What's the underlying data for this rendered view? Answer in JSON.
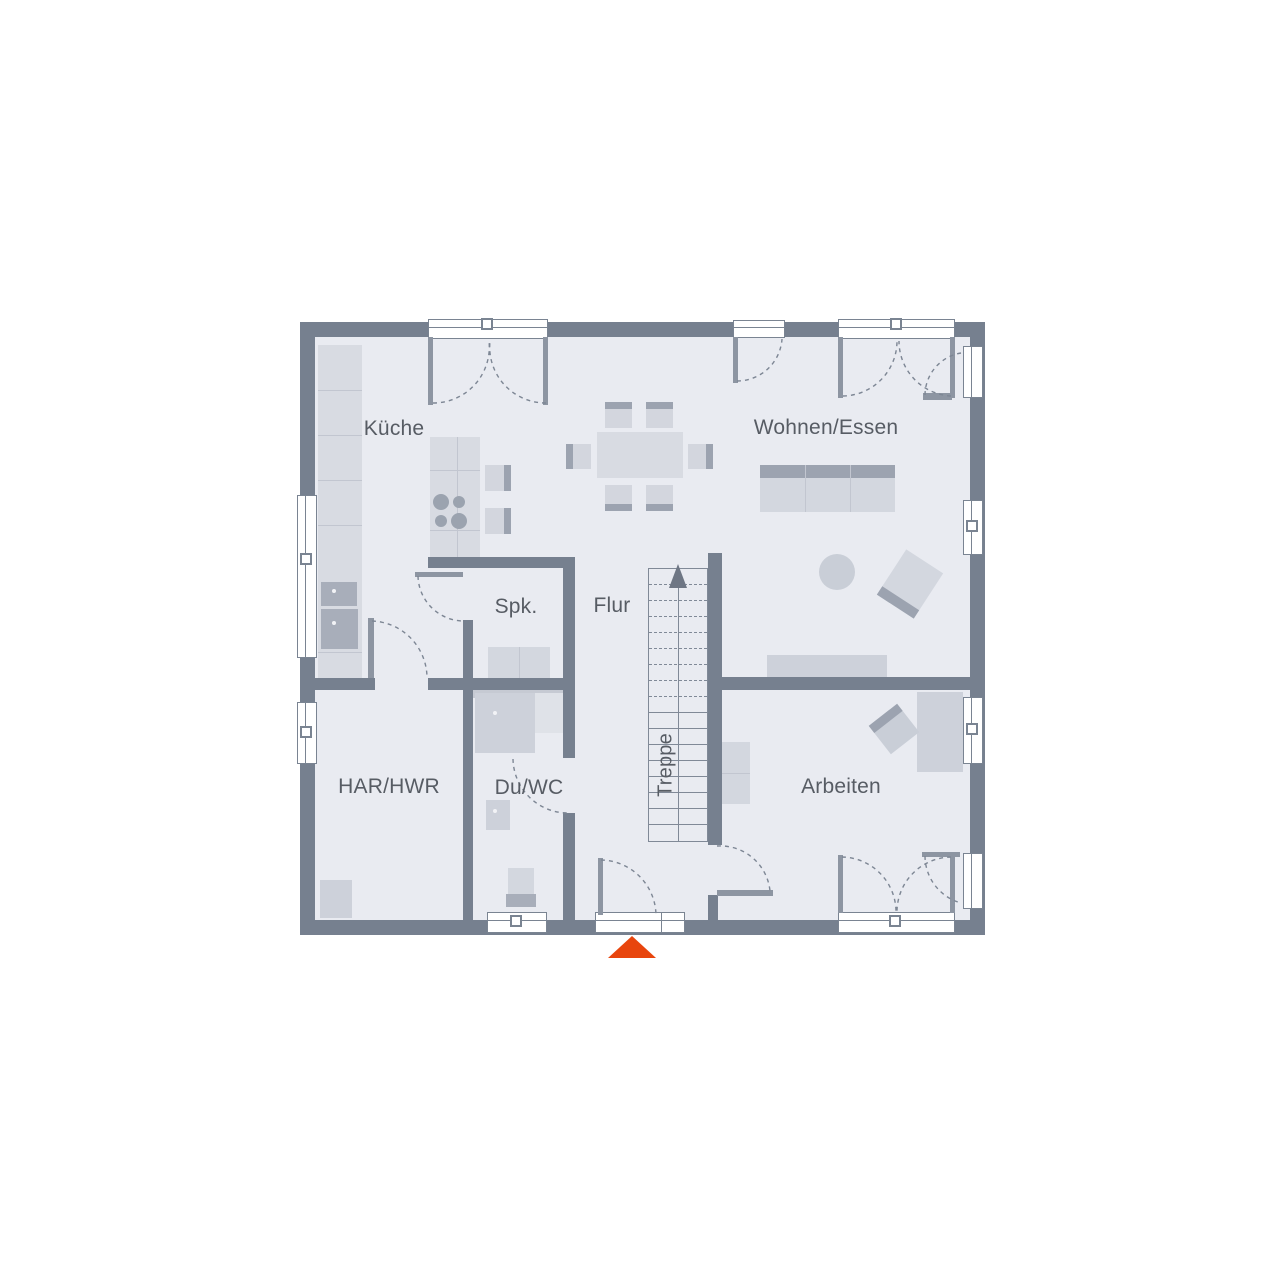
{
  "page": {
    "background": "#FFFFFF",
    "type": "ground-floor-plan"
  },
  "floorplan": {
    "rooms": {
      "kueche": {
        "label": "Küche"
      },
      "wohnen_essen": {
        "label": "Wohnen/Essen"
      },
      "spk": {
        "label": "Spk."
      },
      "flur": {
        "label": "Flur"
      },
      "treppe": {
        "label": "Treppe"
      },
      "har_hwr": {
        "label": "HAR/HWR"
      },
      "du_wc": {
        "label": "Du/WC"
      },
      "arbeiten": {
        "label": "Arbeiten"
      }
    },
    "entrance_marker": {
      "shape": "triangle-up",
      "color": "#E8450D",
      "x": 632,
      "y": 936
    },
    "colors": {
      "wall": "#76808F",
      "floor": "#E9EBF1",
      "furniture_light": "#D8DBE2",
      "furniture_mid": "#CDD1DA",
      "accent_dark": "#9CA3B0",
      "appliance": "#A8AEBA",
      "line": "#7D8694",
      "text": "#575C64",
      "entrance": "#E8450D"
    },
    "geometry": {
      "floor": [
        315,
        337,
        655,
        583
      ],
      "walls": [
        [
          300,
          322,
          685,
          15
        ],
        [
          300,
          920,
          685,
          15
        ],
        [
          300,
          322,
          15,
          613
        ],
        [
          970,
          322,
          15,
          613
        ],
        [
          315,
          678,
          60,
          12
        ],
        [
          428,
          678,
          147,
          12
        ],
        [
          463,
          620,
          10,
          58
        ],
        [
          463,
          690,
          10,
          230
        ],
        [
          428,
          557,
          147,
          11
        ],
        [
          563,
          568,
          12,
          190
        ],
        [
          563,
          813,
          12,
          107
        ],
        [
          708,
          553,
          14,
          292
        ],
        [
          722,
          677,
          263,
          13
        ],
        [
          708,
          895,
          10,
          25
        ]
      ],
      "shadows": [
        [
          473,
          688,
          90,
          10
        ]
      ],
      "windows": [
        {
          "n": "french-door-kueche",
          "r": [
            428,
            319,
            120,
            20
          ],
          "o": "h"
        },
        {
          "n": "door-top-wohnen",
          "r": [
            733,
            320,
            52,
            18
          ],
          "o": "h"
        },
        {
          "n": "french-door-wohnen",
          "r": [
            838,
            319,
            117,
            20
          ],
          "o": "h"
        },
        {
          "n": "window-right-top",
          "r": [
            963,
            346,
            20,
            52
          ],
          "o": "v"
        },
        {
          "n": "window-right-wohnen",
          "r": [
            963,
            500,
            20,
            55
          ],
          "o": "v"
        },
        {
          "n": "window-right-arbeiten",
          "r": [
            963,
            697,
            20,
            67
          ],
          "o": "v"
        },
        {
          "n": "window-right-bottom",
          "r": [
            963,
            853,
            20,
            56
          ],
          "o": "v"
        },
        {
          "n": "window-left-kueche",
          "r": [
            297,
            495,
            20,
            163
          ],
          "o": "v"
        },
        {
          "n": "window-left-har",
          "r": [
            297,
            702,
            20,
            62
          ],
          "o": "v"
        },
        {
          "n": "window-bottom-duwc",
          "r": [
            487,
            912,
            60,
            21
          ],
          "o": "h"
        },
        {
          "n": "entrance-door",
          "r": [
            595,
            912,
            90,
            21
          ],
          "o": "h",
          "div": 660
        },
        {
          "n": "french-door-arbeiten",
          "r": [
            838,
            912,
            117,
            21
          ],
          "o": "h"
        }
      ],
      "handles": [
        {
          "x": 488,
          "y": 325
        },
        {
          "x": 897,
          "y": 325
        },
        {
          "x": 307,
          "y": 560
        },
        {
          "x": 307,
          "y": 733
        },
        {
          "x": 973,
          "y": 527
        },
        {
          "x": 973,
          "y": 730
        },
        {
          "x": 517,
          "y": 922
        },
        {
          "x": 896,
          "y": 922
        }
      ],
      "door_leaves": [
        [
          428,
          337,
          5,
          68
        ],
        [
          543,
          337,
          5,
          68
        ],
        [
          733,
          337,
          5,
          46
        ],
        [
          838,
          337,
          5,
          61
        ],
        [
          950,
          337,
          5,
          61
        ],
        [
          923,
          393,
          29,
          7
        ],
        [
          415,
          572,
          48,
          5
        ],
        [
          368,
          618,
          6,
          60
        ],
        [
          598,
          858,
          5,
          57
        ],
        [
          717,
          890,
          56,
          6
        ],
        [
          922,
          852,
          38,
          5
        ],
        [
          838,
          855,
          5,
          58
        ],
        [
          950,
          855,
          5,
          58
        ]
      ],
      "door_arcs": [
        "M433,403 A56,56 0 0 0 489,341",
        "M546,403 A56,56 0 0 1 490,341",
        "M737,381 A45,45 0 0 0 782,339",
        "M843,396 A55,55 0 0 0 897,341",
        "M951,396 A55,55 0 0 1 899,341",
        "M925,395 A43,43 0 0 1 961,353",
        "M418,576 A46,46 0 0 0 464,621",
        "M372,621 A57,57 0 0 1 427,678",
        "M513,759 A55,55 0 0 0 568,813",
        "M601,860 A56,56 0 0 1 656,915",
        "M717,846 A50,50 0 0 1 770,891",
        "M925,856 A49,49 0 0 0 961,903",
        "M842,857 A55,55 0 0 1 896,911",
        "M951,857 A55,55 0 0 0 897,911"
      ],
      "stairs": {
        "x": 648,
        "y": 568,
        "w": 60,
        "h": 274,
        "step": 16,
        "dashed_count": 8,
        "center_x": 678,
        "arrow": "669,588 687,588 678,564"
      },
      "furniture": [
        {
          "n": "kitchen-counter",
          "r": [
            318,
            345,
            44,
            333
          ],
          "f": "#D8DBE2",
          "lines": [
            [
              "h",
              390
            ],
            [
              "h",
              435
            ],
            [
              "h",
              480
            ],
            [
              "h",
              525
            ],
            [
              "h",
              652
            ]
          ]
        },
        {
          "n": "kitchen-sink",
          "r": [
            321,
            582,
            36,
            24
          ],
          "f": "#A8AEBA",
          "dot": true
        },
        {
          "n": "kitchen-oven",
          "r": [
            321,
            609,
            37,
            40
          ],
          "f": "#A8AEBA",
          "dot": true
        },
        {
          "n": "kitchen-island",
          "r": [
            430,
            437,
            50,
            121
          ],
          "f": "#D8DBE2",
          "lines": [
            [
              "h",
              470
            ],
            [
              "h",
              530
            ],
            [
              "v",
              457
            ]
          ]
        },
        {
          "n": "cooktop-burner",
          "c": [
            441,
            502
          ],
          "rad": 8,
          "f": "#9BA3AF"
        },
        {
          "n": "cooktop-burner",
          "c": [
            459,
            502
          ],
          "rad": 6,
          "f": "#9BA3AF"
        },
        {
          "n": "cooktop-burner",
          "c": [
            441,
            521
          ],
          "rad": 6,
          "f": "#9BA3AF"
        },
        {
          "n": "cooktop-burner",
          "c": [
            459,
            521
          ],
          "rad": 8,
          "f": "#9BA3AF"
        },
        {
          "n": "bar-stool",
          "r": [
            485,
            465,
            26,
            26
          ],
          "f": "#D3D6DE",
          "acc": "r"
        },
        {
          "n": "bar-stool",
          "r": [
            485,
            508,
            26,
            26
          ],
          "f": "#D3D6DE",
          "acc": "r"
        },
        {
          "n": "dining-table",
          "r": [
            597,
            432,
            86,
            46
          ],
          "f": "#D8DBE2"
        },
        {
          "n": "dining-chair",
          "r": [
            605,
            402,
            27,
            26
          ],
          "f": "#D3D6DE",
          "acc": "t"
        },
        {
          "n": "dining-chair",
          "r": [
            646,
            402,
            27,
            26
          ],
          "f": "#D3D6DE",
          "acc": "t"
        },
        {
          "n": "dining-chair",
          "r": [
            605,
            485,
            27,
            26
          ],
          "f": "#D3D6DE",
          "acc": "b"
        },
        {
          "n": "dining-chair",
          "r": [
            646,
            485,
            27,
            26
          ],
          "f": "#D3D6DE",
          "acc": "b"
        },
        {
          "n": "dining-chair",
          "r": [
            566,
            444,
            25,
            25
          ],
          "f": "#D3D6DE",
          "acc": "l"
        },
        {
          "n": "dining-chair",
          "r": [
            688,
            444,
            25,
            25
          ],
          "f": "#D3D6DE",
          "acc": "r"
        },
        {
          "n": "sofa",
          "r": [
            760,
            465,
            135,
            47
          ],
          "f": "#D3D7DF",
          "acc": "t",
          "accs": 13,
          "lines": [
            [
              "v",
              805
            ],
            [
              "v",
              850
            ]
          ]
        },
        {
          "n": "coffee-table",
          "c": [
            837,
            572
          ],
          "rad": 18,
          "f": "#C9CED7"
        },
        {
          "n": "armchair",
          "r": [
            888,
            557,
            44,
            54
          ],
          "f": "#D3D7DF",
          "rot": 33,
          "acc": "b",
          "accs": 10
        },
        {
          "n": "sideboard",
          "r": [
            767,
            655,
            120,
            23
          ],
          "f": "#CDD1DA"
        },
        {
          "n": "desk",
          "r": [
            917,
            692,
            46,
            80
          ],
          "f": "#CDD1DA"
        },
        {
          "n": "desk-chair",
          "r": [
            876,
            711,
            36,
            36
          ],
          "f": "#C9CED7",
          "rot": -38,
          "acc": "t",
          "accs": 9
        },
        {
          "n": "shelf",
          "r": [
            718,
            742,
            32,
            62
          ],
          "f": "#D3D7DF",
          "lines": [
            [
              "h",
              773
            ]
          ]
        },
        {
          "n": "appliance",
          "r": [
            320,
            880,
            32,
            38
          ],
          "f": "#CDD1DA"
        },
        {
          "n": "pantry-shelf",
          "r": [
            488,
            647,
            62,
            31
          ],
          "f": "#D3D7DF",
          "lines": [
            [
              "v",
              519
            ]
          ]
        },
        {
          "n": "shower",
          "r": [
            475,
            693,
            60,
            60
          ],
          "f": "#CDD1DA",
          "dot": true
        },
        {
          "n": "shower-glass",
          "r": [
            535,
            693,
            28,
            40
          ],
          "f": "#DFE2E8"
        },
        {
          "n": "washbasin",
          "r": [
            486,
            800,
            24,
            30
          ],
          "f": "#CDD1DA",
          "dot": true
        },
        {
          "n": "wc-seat",
          "r": [
            508,
            868,
            26,
            26
          ],
          "f": "#D3D7DF"
        },
        {
          "n": "wc-cistern",
          "r": [
            506,
            894,
            30,
            13
          ],
          "f": "#A8AEBA"
        }
      ]
    }
  }
}
